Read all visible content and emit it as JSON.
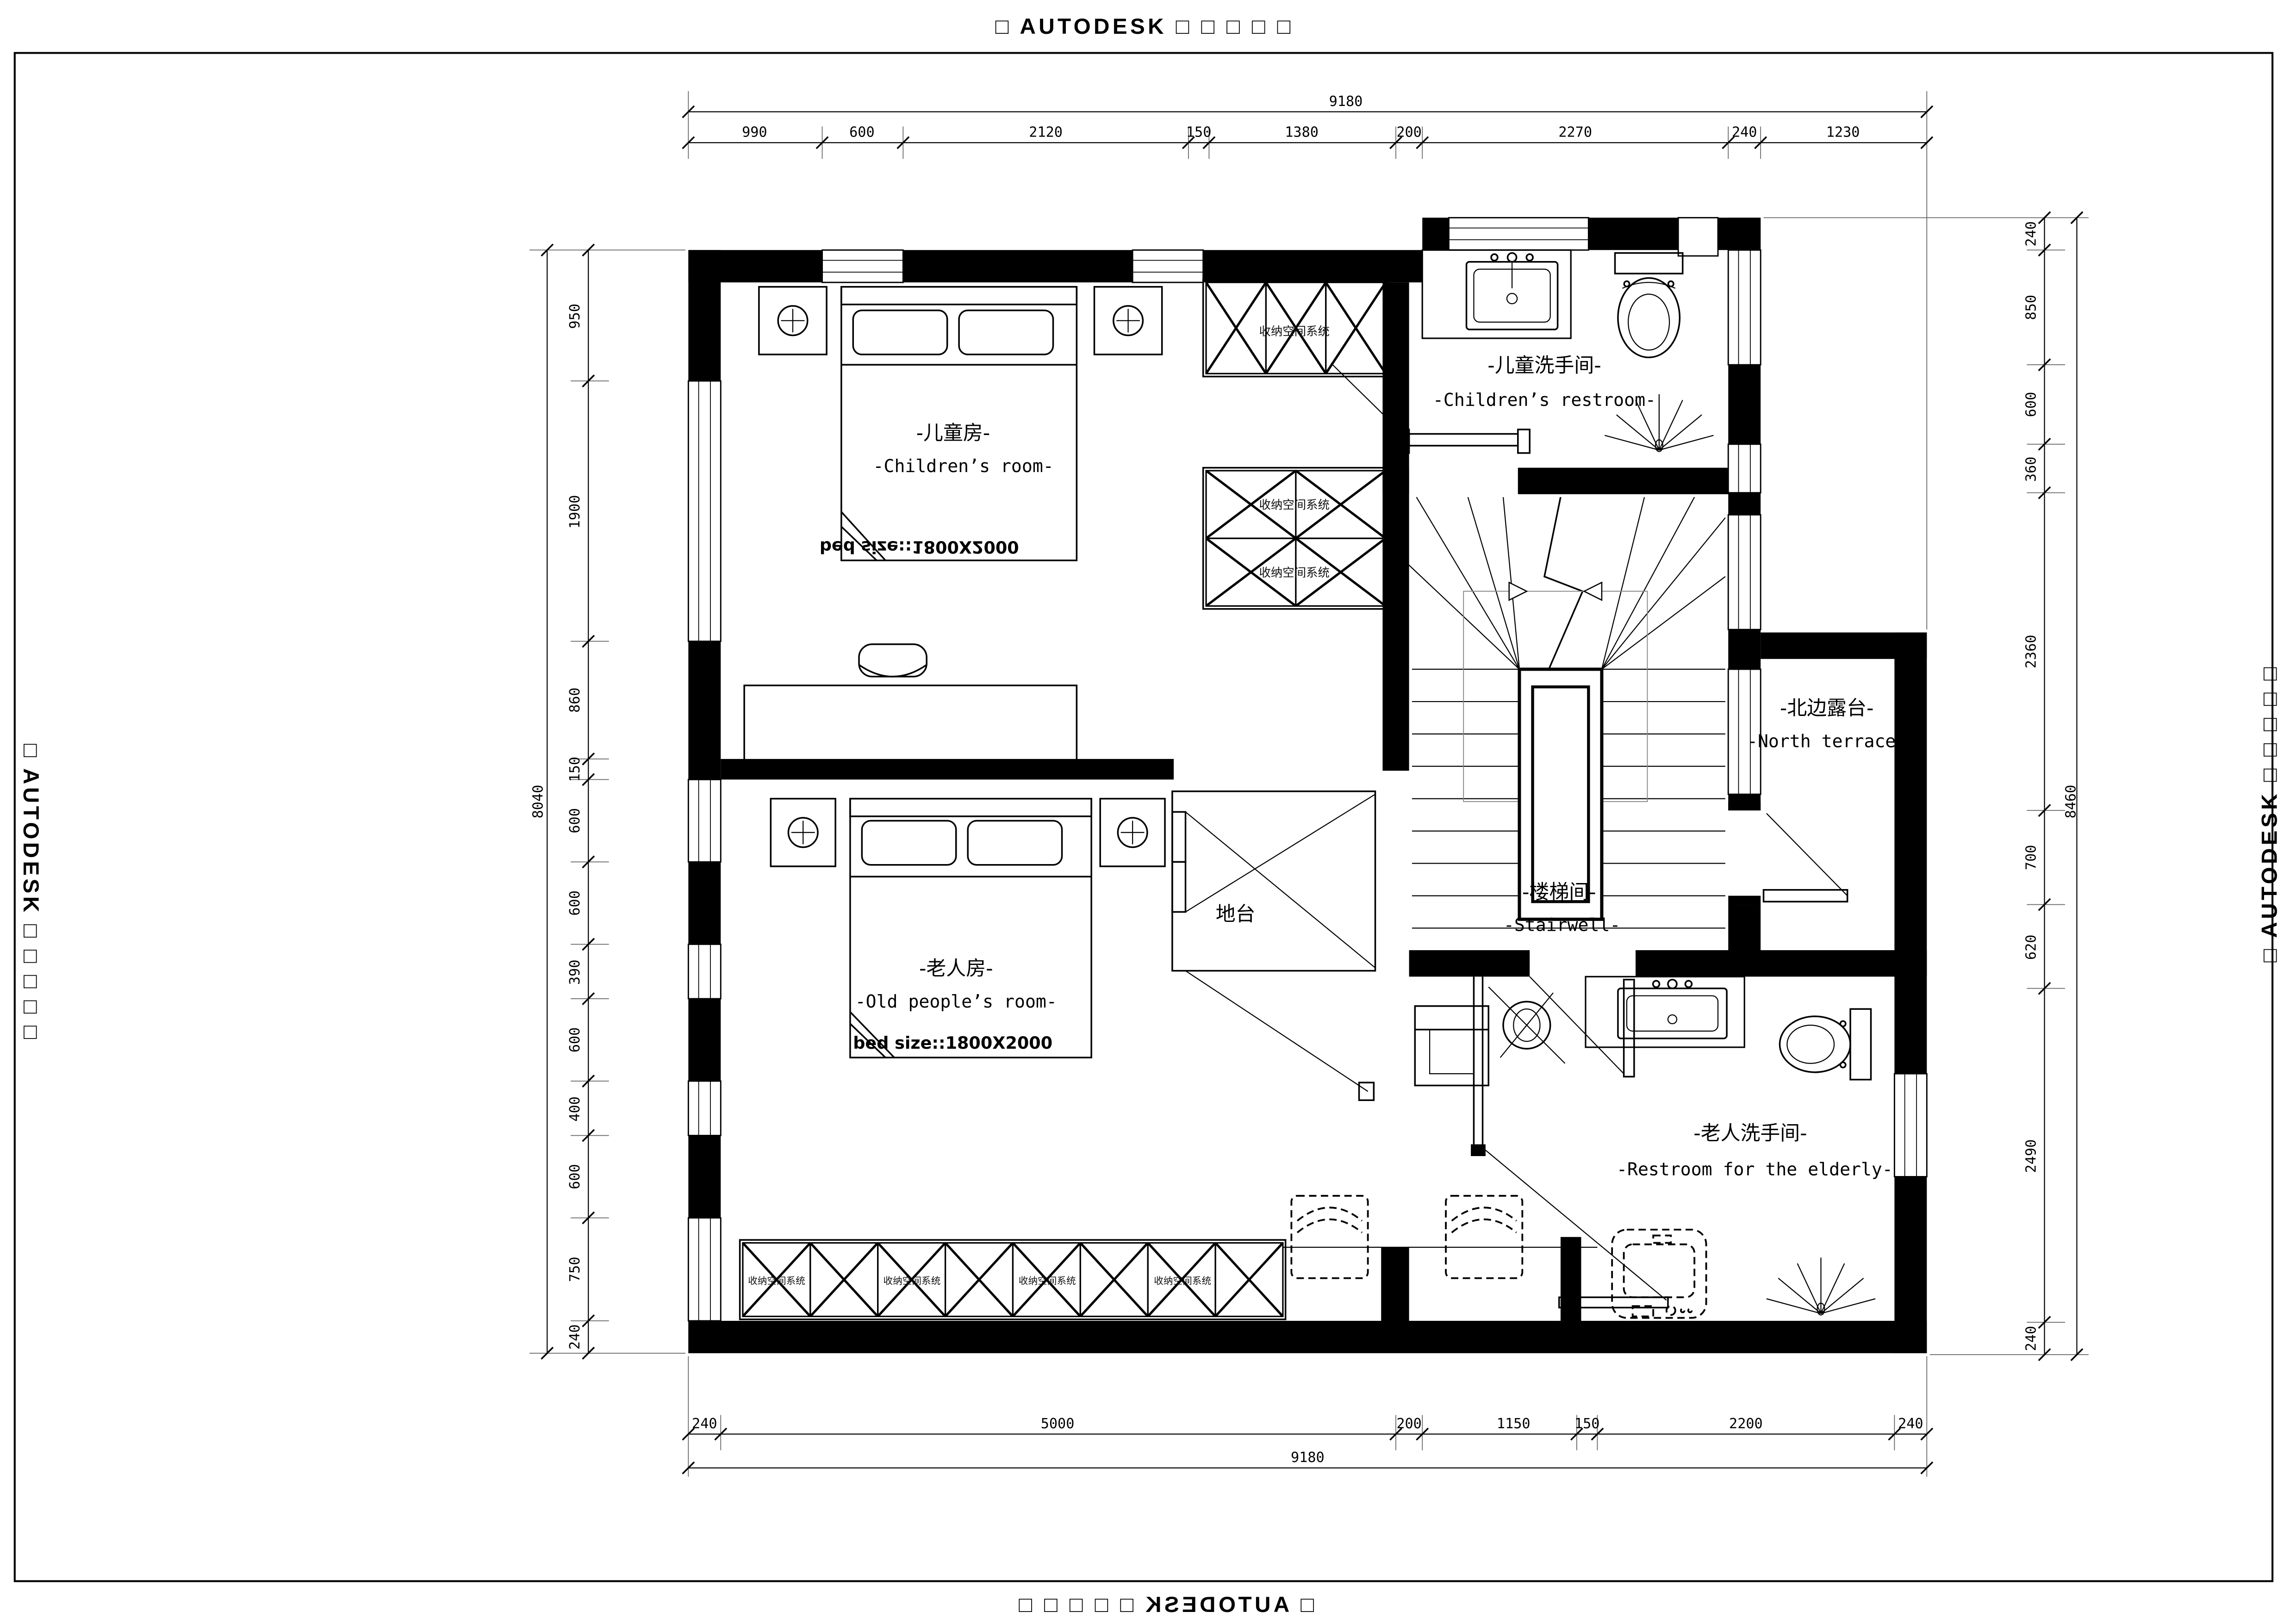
{
  "watermark": {
    "text": "□ AUTODESK □ □ □ □ □"
  },
  "labels": {
    "closet": "收纳空间系统",
    "platform": "地台"
  },
  "rooms": {
    "children": {
      "cn": "-儿童房-",
      "en": "-Children’s room-",
      "bed": "bed size::1800X2000"
    },
    "children_restroom": {
      "cn": "-儿童洗手间-",
      "en": "-Children’s restroom-"
    },
    "terrace": {
      "cn": "-北边露台-",
      "en": "-North terrace-"
    },
    "stairwell": {
      "cn": "-楼梯间-",
      "en": "-Stairwell-"
    },
    "old": {
      "cn": "-老人房-",
      "en": "-Old people’s room-",
      "bed": "bed size::1800X2000"
    },
    "old_restroom": {
      "cn": "-老人洗手间-",
      "en": "-Restroom for the elderly-"
    }
  },
  "dims": {
    "top": {
      "total": "9180",
      "segments": [
        "990",
        "600",
        "2120",
        "150",
        "1380",
        "200",
        "2270",
        "240",
        "1230"
      ]
    },
    "bottom": {
      "total": "9180",
      "segments": [
        "240",
        "5000",
        "200",
        "1150",
        "150",
        "2200",
        "240"
      ]
    },
    "left": {
      "total": "8040",
      "segments": [
        "950",
        "1900",
        "860",
        "150",
        "600",
        "600",
        "390",
        "600",
        "400",
        "600",
        "750",
        "240"
      ]
    },
    "right": {
      "total": "8460",
      "segments": [
        "240",
        "850",
        "600",
        "360",
        "2360",
        "700",
        "620",
        "2490",
        "240"
      ]
    }
  }
}
